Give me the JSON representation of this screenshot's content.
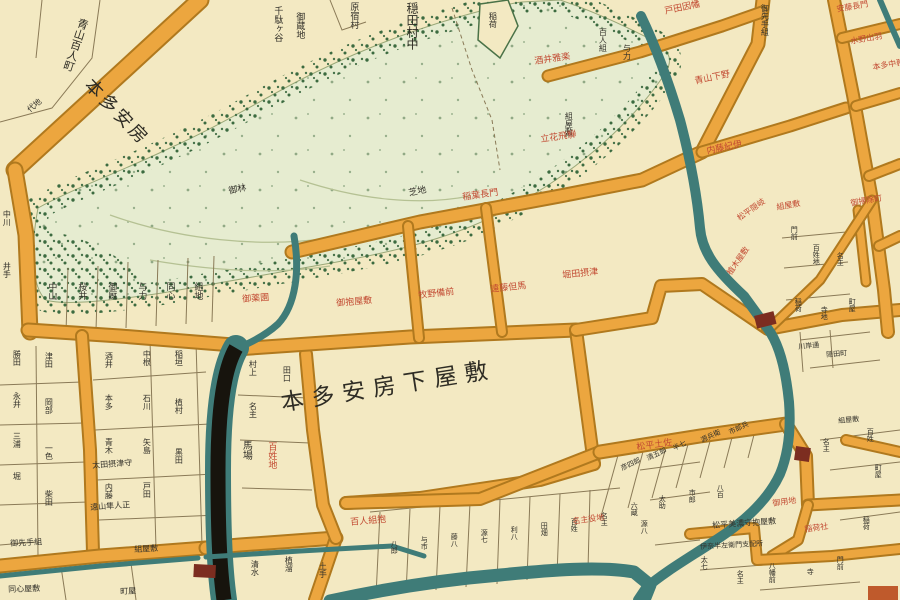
{
  "colors": {
    "paper": "#f3e9c2",
    "road": "#eca63f",
    "road_edge": "#b0791e",
    "green_wash": "#e6ecd0",
    "green_stipple": "#3c6b40",
    "water": "#3f7c78",
    "canal": "#17140d",
    "ink": "#33312a",
    "red_label": "#c24a32",
    "bridge": "#7c2d20",
    "parcel_line": "#8a7a57"
  },
  "featured": {
    "center_estate": "本多安房下屋敷",
    "upper_left_estate": "本多安房",
    "village": "穏田村中",
    "street": "青山百人町"
  },
  "labels": {
    "black": [
      {
        "text": "千駄ヶ谷",
        "x": 272,
        "y": 6,
        "s": 9,
        "v": true
      },
      {
        "text": "御蔵地",
        "x": 294,
        "y": 12,
        "s": 9,
        "v": true
      },
      {
        "text": "原宿村",
        "x": 348,
        "y": 2,
        "s": 9,
        "v": true
      },
      {
        "text": "稲荷",
        "x": 488,
        "y": 12,
        "s": 8,
        "v": true
      },
      {
        "text": "御先手組",
        "x": 760,
        "y": 4,
        "s": 8,
        "v": true
      },
      {
        "text": "百人組",
        "x": 598,
        "y": 28,
        "s": 8,
        "v": true
      },
      {
        "text": "与力",
        "x": 622,
        "y": 44,
        "s": 8,
        "v": true
      },
      {
        "text": "組屋敷",
        "x": 564,
        "y": 112,
        "s": 8,
        "v": true
      },
      {
        "text": "御林",
        "x": 228,
        "y": 188,
        "s": 9,
        "r": -12
      },
      {
        "text": "芝地",
        "x": 408,
        "y": 190,
        "s": 9,
        "r": -12
      },
      {
        "text": "代地",
        "x": 26,
        "y": 108,
        "s": 8,
        "r": -40
      },
      {
        "text": "中川",
        "x": 2,
        "y": 210,
        "s": 8,
        "v": true
      },
      {
        "text": "井手",
        "x": 2,
        "y": 262,
        "s": 8,
        "v": true
      },
      {
        "text": "中山",
        "x": 46,
        "y": 282,
        "s": 9,
        "v": true
      },
      {
        "text": "桜井",
        "x": 76,
        "y": 282,
        "s": 9,
        "v": true
      },
      {
        "text": "御厩",
        "x": 106,
        "y": 282,
        "s": 9,
        "v": true
      },
      {
        "text": "与力",
        "x": 136,
        "y": 282,
        "s": 9,
        "v": true
      },
      {
        "text": "同心",
        "x": 164,
        "y": 282,
        "s": 9,
        "v": true
      },
      {
        "text": "組地",
        "x": 192,
        "y": 282,
        "s": 9,
        "v": true
      },
      {
        "text": "勝田",
        "x": 12,
        "y": 350,
        "s": 8,
        "v": true
      },
      {
        "text": "永井",
        "x": 12,
        "y": 392,
        "s": 8,
        "v": true
      },
      {
        "text": "三浦",
        "x": 12,
        "y": 432,
        "s": 8,
        "v": true
      },
      {
        "text": "堀",
        "x": 12,
        "y": 472,
        "s": 8,
        "v": true
      },
      {
        "text": "津田",
        "x": 44,
        "y": 352,
        "s": 8,
        "v": true
      },
      {
        "text": "岡部",
        "x": 44,
        "y": 398,
        "s": 8,
        "v": true
      },
      {
        "text": "一色",
        "x": 44,
        "y": 444,
        "s": 8,
        "v": true
      },
      {
        "text": "柴田",
        "x": 44,
        "y": 490,
        "s": 8,
        "v": true
      },
      {
        "text": "酒井",
        "x": 104,
        "y": 352,
        "s": 8,
        "v": true
      },
      {
        "text": "本多",
        "x": 104,
        "y": 394,
        "s": 8,
        "v": true
      },
      {
        "text": "青木",
        "x": 104,
        "y": 438,
        "s": 8,
        "v": true
      },
      {
        "text": "内藤",
        "x": 104,
        "y": 483,
        "s": 8,
        "v": true
      },
      {
        "text": "中根",
        "x": 142,
        "y": 350,
        "s": 8,
        "v": true
      },
      {
        "text": "石川",
        "x": 142,
        "y": 394,
        "s": 8,
        "v": true
      },
      {
        "text": "矢島",
        "x": 142,
        "y": 438,
        "s": 8,
        "v": true
      },
      {
        "text": "戸田",
        "x": 142,
        "y": 482,
        "s": 8,
        "v": true
      },
      {
        "text": "稲垣",
        "x": 174,
        "y": 350,
        "s": 8,
        "v": true
      },
      {
        "text": "植村",
        "x": 174,
        "y": 398,
        "s": 8,
        "v": true
      },
      {
        "text": "黒田",
        "x": 174,
        "y": 448,
        "s": 8,
        "v": true
      },
      {
        "text": "太田摂津守",
        "x": 92,
        "y": 462,
        "s": 8,
        "r": -4
      },
      {
        "text": "遠山隼人正",
        "x": 90,
        "y": 504,
        "s": 8,
        "r": -4
      },
      {
        "text": "御先手組",
        "x": 10,
        "y": 540,
        "s": 8,
        "r": -3
      },
      {
        "text": "組屋敷",
        "x": 134,
        "y": 546,
        "s": 8,
        "r": -3
      },
      {
        "text": "同心屋敷",
        "x": 8,
        "y": 586,
        "s": 8,
        "r": -2
      },
      {
        "text": "町屋",
        "x": 120,
        "y": 588,
        "s": 8,
        "r": -2
      },
      {
        "text": "村上",
        "x": 248,
        "y": 360,
        "s": 8,
        "v": true
      },
      {
        "text": "名主",
        "x": 248,
        "y": 402,
        "s": 8,
        "v": true
      },
      {
        "text": "田口",
        "x": 282,
        "y": 366,
        "s": 8,
        "v": true
      },
      {
        "text": "馬場",
        "x": 240,
        "y": 440,
        "s": 10,
        "v": true
      },
      {
        "text": "清水",
        "x": 250,
        "y": 560,
        "s": 8,
        "v": true
      },
      {
        "text": "植溜",
        "x": 284,
        "y": 556,
        "s": 8,
        "v": true
      },
      {
        "text": "土手",
        "x": 318,
        "y": 562,
        "s": 8,
        "v": true
      },
      {
        "text": "八郎",
        "x": 390,
        "y": 540,
        "s": 7,
        "v": true
      },
      {
        "text": "与市",
        "x": 420,
        "y": 536,
        "s": 7,
        "v": true
      },
      {
        "text": "藤八",
        "x": 450,
        "y": 533,
        "s": 7,
        "v": true
      },
      {
        "text": "源七",
        "x": 480,
        "y": 529,
        "s": 7,
        "v": true
      },
      {
        "text": "利八",
        "x": 510,
        "y": 526,
        "s": 7,
        "v": true
      },
      {
        "text": "田畑",
        "x": 540,
        "y": 522,
        "s": 7,
        "v": true
      },
      {
        "text": "百姓",
        "x": 570,
        "y": 518,
        "s": 7,
        "v": true
      },
      {
        "text": "名主",
        "x": 600,
        "y": 512,
        "s": 7,
        "v": true
      },
      {
        "text": "六蔵",
        "x": 630,
        "y": 502,
        "s": 7,
        "v": true
      },
      {
        "text": "太助",
        "x": 658,
        "y": 495,
        "s": 7,
        "v": true
      },
      {
        "text": "市郎",
        "x": 688,
        "y": 489,
        "s": 7,
        "v": true
      },
      {
        "text": "八百",
        "x": 716,
        "y": 484,
        "s": 7,
        "v": true
      },
      {
        "text": "彦四郎",
        "x": 620,
        "y": 466,
        "s": 7,
        "r": -25
      },
      {
        "text": "清五郎",
        "x": 646,
        "y": 456,
        "s": 7,
        "r": -25
      },
      {
        "text": "半七",
        "x": 672,
        "y": 446,
        "s": 7,
        "r": -25
      },
      {
        "text": "源兵衛",
        "x": 700,
        "y": 438,
        "s": 7,
        "r": -25
      },
      {
        "text": "市郎兵",
        "x": 728,
        "y": 430,
        "s": 7,
        "r": -25
      },
      {
        "text": "門前",
        "x": 790,
        "y": 226,
        "s": 7,
        "v": true
      },
      {
        "text": "百姓地",
        "x": 812,
        "y": 244,
        "s": 7,
        "v": true
      },
      {
        "text": "名主",
        "x": 836,
        "y": 252,
        "s": 7,
        "v": true
      },
      {
        "text": "稲荷",
        "x": 794,
        "y": 298,
        "s": 7,
        "v": true
      },
      {
        "text": "寺地",
        "x": 820,
        "y": 306,
        "s": 7,
        "v": true
      },
      {
        "text": "町屋",
        "x": 848,
        "y": 298,
        "s": 7,
        "v": true
      },
      {
        "text": "川岸通",
        "x": 798,
        "y": 344,
        "s": 7,
        "r": -5
      },
      {
        "text": "隠田町",
        "x": 826,
        "y": 352,
        "s": 7,
        "r": -5
      },
      {
        "text": "組屋敷",
        "x": 838,
        "y": 418,
        "s": 7,
        "r": -5
      },
      {
        "text": "百姓",
        "x": 866,
        "y": 428,
        "s": 7,
        "v": true
      },
      {
        "text": "名主",
        "x": 822,
        "y": 438,
        "s": 7,
        "v": true
      },
      {
        "text": "源八",
        "x": 640,
        "y": 520,
        "s": 7,
        "v": true
      },
      {
        "text": "太七",
        "x": 700,
        "y": 556,
        "s": 7,
        "v": true
      },
      {
        "text": "名主",
        "x": 736,
        "y": 570,
        "s": 7,
        "v": true
      },
      {
        "text": "八幡前",
        "x": 768,
        "y": 562,
        "s": 7,
        "v": true
      },
      {
        "text": "寺",
        "x": 806,
        "y": 568,
        "s": 7,
        "v": true
      },
      {
        "text": "門前",
        "x": 836,
        "y": 556,
        "s": 7,
        "v": true
      },
      {
        "text": "稲荷",
        "x": 862,
        "y": 516,
        "s": 7,
        "v": true
      },
      {
        "text": "町屋",
        "x": 874,
        "y": 464,
        "s": 7,
        "v": true
      },
      {
        "text": "松平美濃守抱屋敷",
        "x": 712,
        "y": 522,
        "s": 8,
        "r": -4
      },
      {
        "text": "伊奈半左衛門支配所",
        "x": 700,
        "y": 544,
        "s": 7,
        "r": -3
      }
    ],
    "red": [
      {
        "text": "戸田因幡",
        "x": 664,
        "y": 8,
        "s": 9,
        "r": -12
      },
      {
        "text": "青山下野",
        "x": 694,
        "y": 78,
        "s": 9,
        "r": -12
      },
      {
        "text": "内藤紀伊",
        "x": 706,
        "y": 148,
        "s": 9,
        "r": -12
      },
      {
        "text": "安藤長門",
        "x": 836,
        "y": 6,
        "s": 8,
        "r": -10
      },
      {
        "text": "水野出羽",
        "x": 850,
        "y": 38,
        "s": 8,
        "r": -10
      },
      {
        "text": "本多中務",
        "x": 872,
        "y": 64,
        "s": 8,
        "r": -10
      },
      {
        "text": "酒井雅楽",
        "x": 534,
        "y": 58,
        "s": 9,
        "r": -8
      },
      {
        "text": "立花飛騨",
        "x": 540,
        "y": 136,
        "s": 9,
        "r": -8
      },
      {
        "text": "稲葉長門",
        "x": 462,
        "y": 194,
        "s": 9,
        "r": -8
      },
      {
        "text": "牧野備前",
        "x": 418,
        "y": 292,
        "s": 9,
        "r": -6
      },
      {
        "text": "遠藤但馬",
        "x": 490,
        "y": 286,
        "s": 9,
        "r": -6
      },
      {
        "text": "堀田摂津",
        "x": 562,
        "y": 272,
        "s": 9,
        "r": -6
      },
      {
        "text": "御薬園",
        "x": 242,
        "y": 296,
        "s": 9,
        "r": -4
      },
      {
        "text": "御抱屋敷",
        "x": 336,
        "y": 300,
        "s": 9,
        "r": -5
      },
      {
        "text": "松平隠岐",
        "x": 736,
        "y": 216,
        "s": 8,
        "r": -35
      },
      {
        "text": "植木屋敷",
        "x": 726,
        "y": 272,
        "s": 8,
        "r": -55
      },
      {
        "text": "百姓地",
        "x": 266,
        "y": 442,
        "s": 9,
        "v": true
      },
      {
        "text": "百人組抱",
        "x": 350,
        "y": 519,
        "s": 9,
        "r": -5
      },
      {
        "text": "松平土佐",
        "x": 636,
        "y": 444,
        "s": 9,
        "r": -8
      },
      {
        "text": "御用地",
        "x": 772,
        "y": 500,
        "s": 8,
        "r": -8
      },
      {
        "text": "稲荷社",
        "x": 804,
        "y": 526,
        "s": 8,
        "r": -8
      },
      {
        "text": "御掃除町",
        "x": 850,
        "y": 200,
        "s": 8,
        "r": -10
      },
      {
        "text": "組屋敷",
        "x": 776,
        "y": 204,
        "s": 8,
        "r": -10
      },
      {
        "text": "名主役地",
        "x": 572,
        "y": 518,
        "s": 8,
        "r": -8
      }
    ]
  }
}
